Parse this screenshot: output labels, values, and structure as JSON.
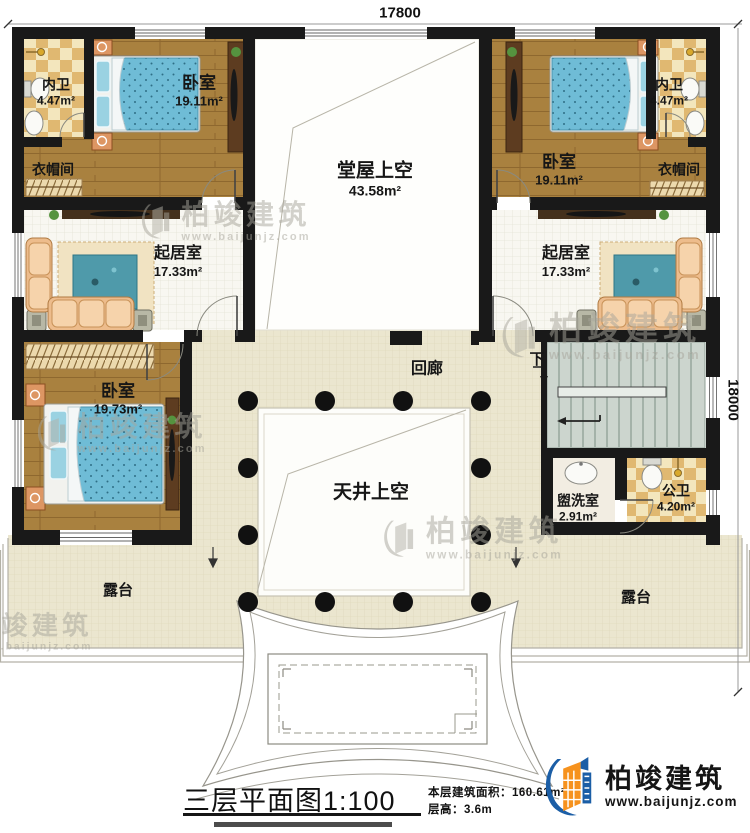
{
  "dimensions": {
    "top": "17800",
    "right": "18000"
  },
  "rooms": {
    "bath_top_left": {
      "name": "内卫",
      "area": "4.47m²"
    },
    "bedroom_top_left": {
      "name": "卧室",
      "area": "19.11m²"
    },
    "closet_top_left": {
      "name": "衣帽间"
    },
    "hall_void": {
      "name": "堂屋上空",
      "area": "43.58m²"
    },
    "bedroom_top_right": {
      "name": "卧室",
      "area": "19.11m²"
    },
    "bath_top_right": {
      "name": "内卫",
      "area": "4.47m²"
    },
    "closet_top_right": {
      "name": "衣帽间"
    },
    "living_left": {
      "name": "起居室",
      "area": "17.33m²"
    },
    "living_right": {
      "name": "起居室",
      "area": "17.33m²"
    },
    "bedroom_bottom_left": {
      "name": "卧室",
      "area": "19.73m²"
    },
    "corridor": {
      "name": "回廊"
    },
    "courtyard_void": {
      "name": "天井上空"
    },
    "washroom": {
      "name": "盥洗室",
      "area": "2.91m²"
    },
    "public_toilet": {
      "name": "公卫",
      "area": "4.20m²"
    },
    "terrace_left": {
      "name": "露台"
    },
    "terrace_right": {
      "name": "露台"
    }
  },
  "stairs": {
    "down_label": "下"
  },
  "title_block": {
    "title": "三层平面图",
    "scale": "1:100",
    "area_label": "本层建筑面积：",
    "area_value": "160.61m²",
    "floor_height_label": "层高：",
    "floor_height_value": "3.6m"
  },
  "brand": {
    "name": "柏竣建筑",
    "url": "www.baijunjz.com"
  },
  "watermark": {
    "name": "柏竣建筑",
    "url": "www.baijunjz.com"
  },
  "colors": {
    "wall": "#191919",
    "brand_blue": "#1b5ea6",
    "brand_orange": "#f6921e",
    "bed_blue": "#6fbcd6",
    "checker_tan": "#e0b871",
    "cream": "#ebe6cf"
  }
}
